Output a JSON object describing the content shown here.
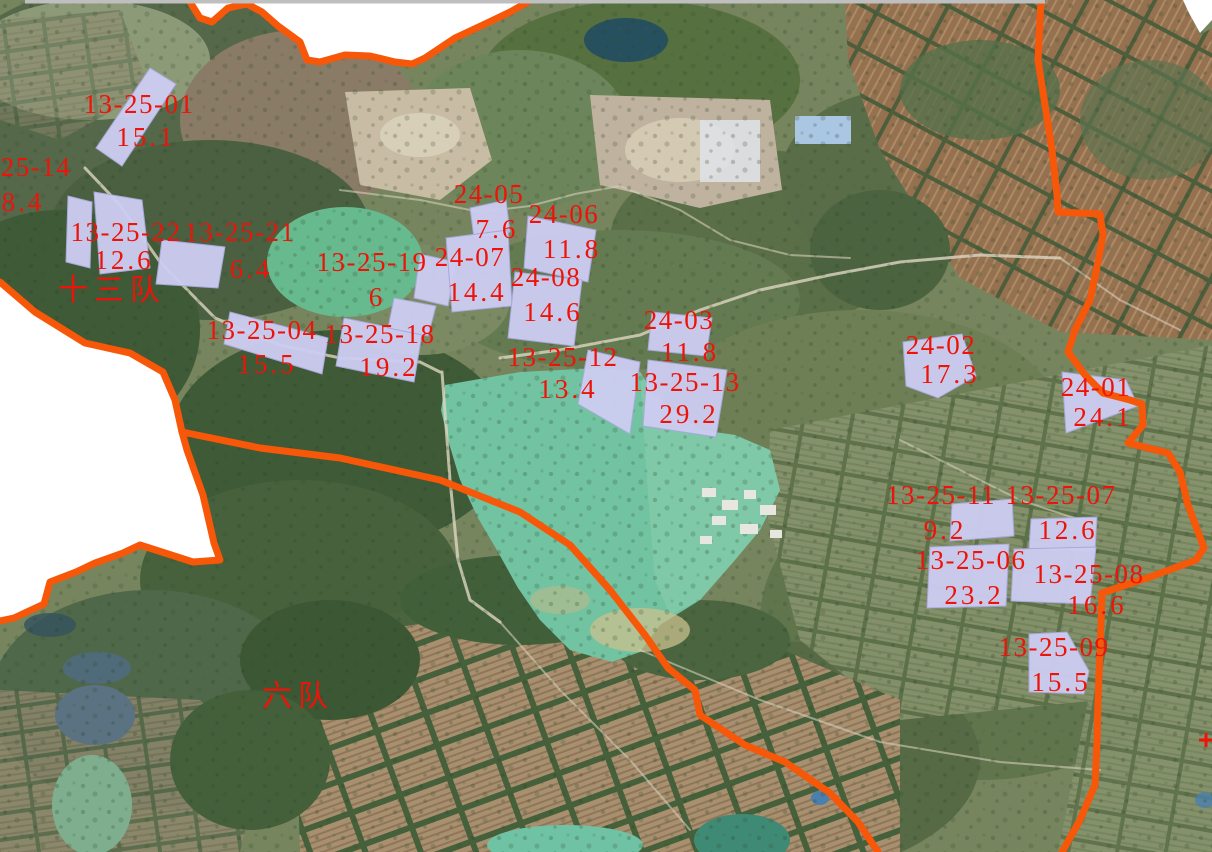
{
  "map": {
    "type": "satellite-parcel-map",
    "colors": {
      "annotation_red": "#ee1309",
      "boundary_orange": "#f75708",
      "parcel_fill": "#ccccf0",
      "lake_teal": "#72c3a2",
      "outside_mask": "#ffffff"
    },
    "zones": [
      {
        "name": "十三队",
        "x": 112,
        "y": 276
      },
      {
        "name": "六队",
        "x": 298,
        "y": 682
      }
    ],
    "parcels": [
      {
        "id": "13-25-01",
        "area": "15.1",
        "id_x": 139,
        "id_y": 91,
        "v_x": 146,
        "v_y": 124,
        "poly": "150,68 176,84 122,166 96,148"
      },
      {
        "id": "25-14",
        "area": "8.4",
        "id_x": 36,
        "id_y": 154,
        "v_x": 23,
        "v_y": 189,
        "poly": "68,196 92,202 90,268 66,262"
      },
      {
        "id": "13-25-22",
        "area": "12.6",
        "id_x": 126,
        "id_y": 219,
        "v_x": 124,
        "v_y": 247,
        "poly": "94,192 142,200 150,268 100,274"
      },
      {
        "id": "13-25-21",
        "area": "6.4",
        "id_x": 240,
        "id_y": 219,
        "v_x": 251,
        "v_y": 256,
        "poly": "162,240 225,247 218,288 156,284"
      },
      {
        "id": "13-25-19",
        "area": "6",
        "id_x": 372,
        "id_y": 249,
        "v_x": 377,
        "v_y": 284,
        "poly": "420,254 456,262 448,306 414,298"
      },
      {
        "id": "24-05",
        "area": "7.6",
        "id_x": 489,
        "id_y": 181,
        "v_x": 497,
        "v_y": 216,
        "poly": "470,208 506,200 510,232 474,238"
      },
      {
        "id": "24-06",
        "area": "11.8",
        "id_x": 564,
        "id_y": 201,
        "v_x": 572,
        "v_y": 236,
        "poly": "528,216 596,230 588,282 524,268"
      },
      {
        "id": "24-07",
        "area": "14.4",
        "id_x": 470,
        "id_y": 244,
        "v_x": 477,
        "v_y": 279,
        "poly": "446,238 508,230 512,306 452,312"
      },
      {
        "id": "24-08",
        "area": "14.6",
        "id_x": 546,
        "id_y": 264,
        "v_x": 553,
        "v_y": 299,
        "poly": "515,272 582,280 574,346 508,338"
      },
      {
        "id": "13-25-04",
        "area": "15.5",
        "id_x": 262,
        "id_y": 317,
        "v_x": 267,
        "v_y": 351,
        "poly": "230,312 328,338 322,374 224,344"
      },
      {
        "id": "13-25-18",
        "area": "19.2",
        "id_x": 380,
        "id_y": 321,
        "v_x": 389,
        "v_y": 354,
        "poly": "344,318 422,334 414,382 336,366"
      },
      {
        "id": "13-25-12",
        "area": "13.4",
        "id_x": 563,
        "id_y": 344,
        "v_x": 568,
        "v_y": 376,
        "poly": "588,350 640,362 630,434 578,404"
      },
      {
        "id": "13-25-13",
        "area": "29.2",
        "id_x": 685,
        "id_y": 369,
        "v_x": 689,
        "v_y": 401,
        "poly": "648,360 727,370 716,437 643,426"
      },
      {
        "id": "24-03",
        "area": "11.8",
        "id_x": 679,
        "id_y": 307,
        "v_x": 690,
        "v_y": 339,
        "poly": "652,312 712,318 706,356 648,350"
      },
      {
        "id": "24-02",
        "area": "17.3",
        "id_x": 941,
        "id_y": 332,
        "v_x": 950,
        "v_y": 361,
        "poly": "903,342 962,334 976,376 938,398 906,386"
      },
      {
        "id": "24-01",
        "area": "24.1",
        "id_x": 1096,
        "id_y": 374,
        "v_x": 1103,
        "v_y": 404,
        "poly": "1062,372 1126,380 1138,406 1066,433"
      },
      {
        "id": "13-25-11",
        "area": "9.2",
        "id_x": 941,
        "id_y": 482,
        "v_x": 945,
        "v_y": 517,
        "poly": "952,504 1012,499 1014,536 950,541"
      },
      {
        "id": "13-25-07",
        "area": "12.6",
        "id_x": 1061,
        "id_y": 482,
        "v_x": 1068,
        "v_y": 517,
        "poly": "1031,519 1097,517 1095,551 1029,549"
      },
      {
        "id": "13-25-06",
        "area": "23.2",
        "id_x": 971,
        "id_y": 547,
        "v_x": 974,
        "v_y": 582,
        "poly": "930,547 1009,544 1006,606 927,608"
      },
      {
        "id": "13-25-08",
        "area": "16.6",
        "id_x": 1089,
        "id_y": 561,
        "v_x": 1097,
        "v_y": 592,
        "poly": "1014,549 1096,547 1090,604 1011,601"
      },
      {
        "id": "13-25-09",
        "area": "15.5",
        "id_x": 1054,
        "id_y": 634,
        "v_x": 1061,
        "v_y": 669,
        "poly": "1029,634 1067,632 1089,671 1084,694 1029,692"
      },
      {
        "id": "13-25-19b",
        "area": "",
        "id_x": -500,
        "id_y": -500,
        "v_x": -500,
        "v_y": -500,
        "poly": "394,298 436,306 428,336 388,328"
      }
    ],
    "markers": [
      {
        "type": "cross",
        "x": 1206,
        "y": 740
      }
    ]
  }
}
